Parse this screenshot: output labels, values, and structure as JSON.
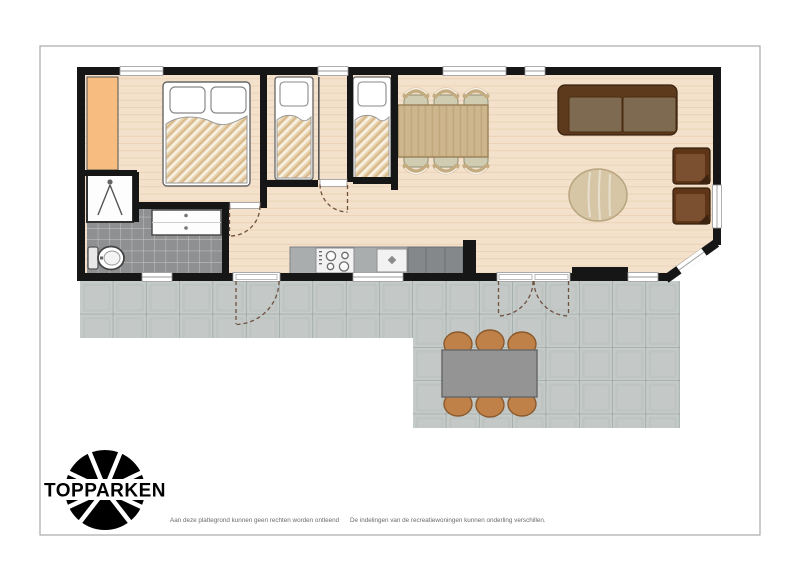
{
  "logo": {
    "text": "TOPPARKEN",
    "color": "#1f97d4"
  },
  "footer": {
    "left": "Aan deze plattegrond kunnen geen rechten worden ontleend",
    "right": "De indelingen van de recreatiewoningen kunnen onderling verschillen."
  },
  "palette": {
    "floor": "#f4e1cb",
    "plank": "#e3c3a1",
    "wall": "#161616",
    "closet": "#f6bc80",
    "bath_tile": "#8f9091",
    "bath_grid": "#c9c9c9",
    "terrace_tile": "#c5cbc8",
    "terrace_grid": "#8d9996",
    "counter": "#a9adae",
    "cabinet": "#84888a",
    "appliance": "#f2f2f2",
    "sofa": "#5d3a1c",
    "sofa_cushion": "#7d6a50",
    "armchair": "#5e3517",
    "armchair_seat": "#7b5030",
    "table_wood": "#cdb58d",
    "chair_seat": "#cfccb2",
    "chair_back": "#c4ab80",
    "rug": "#d6c6a6",
    "outdoor_table": "#949494",
    "outdoor_chair": "#bf8148",
    "blanket": "#e8d2ac",
    "bed": "#ffffff",
    "dash": "#6f5140",
    "border": "#a9a9a9"
  }
}
